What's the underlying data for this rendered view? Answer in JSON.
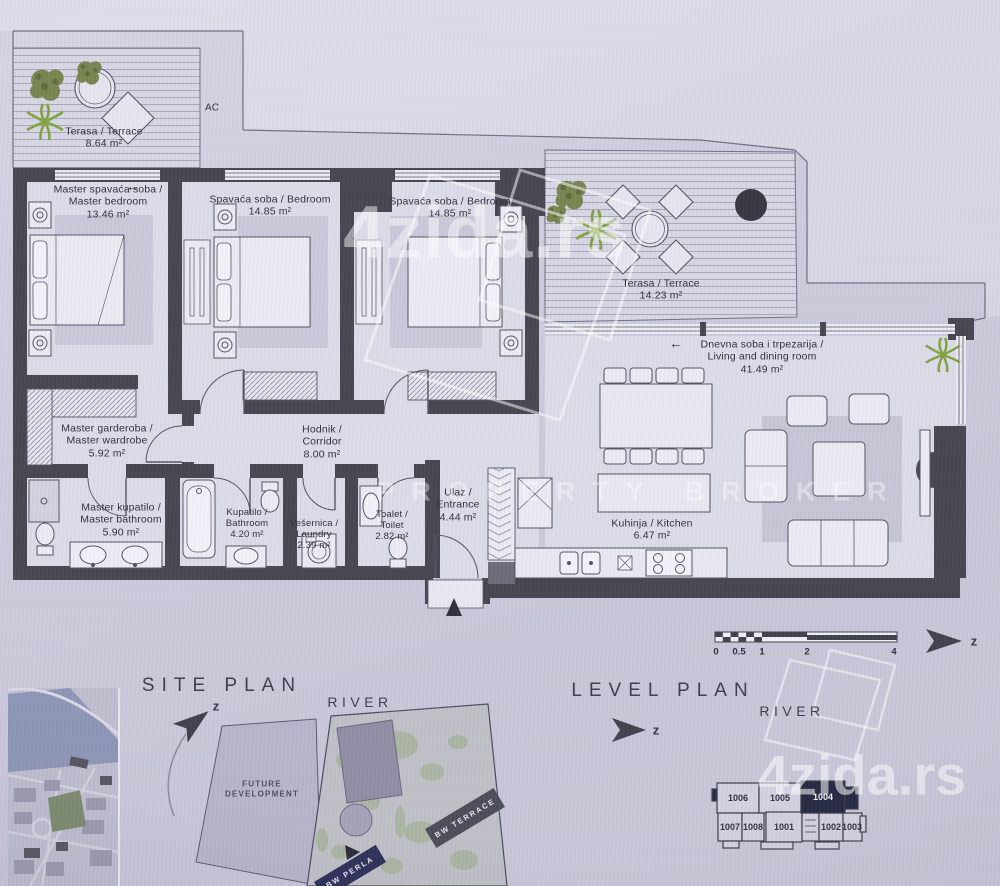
{
  "watermark": {
    "brand_top": "4zida.rs",
    "brand_bottom": "4zida.rs",
    "broker": "PROPERTY BROKER"
  },
  "plan": {
    "ac_label": "AC",
    "arrow": "←",
    "rooms": [
      {
        "line1": "Terasa / Terrace",
        "area": "8.64 m²"
      },
      {
        "line1": "Master spavaća soba /",
        "line2": "Master bedroom",
        "area": "13.46 m²"
      },
      {
        "line1": "Spavaća soba / Bedroom",
        "area": "14.85 m²"
      },
      {
        "line1": "Spavaća soba / Bedroom",
        "area": "14.85 m²"
      },
      {
        "line1": "Terasa / Terrace",
        "area": "14.23 m²"
      },
      {
        "line1": "Dnevna soba i trpezarija /",
        "line2": "Living and dining room",
        "area": "41.49 m²"
      },
      {
        "line1": "Master garderoba /",
        "line2": "Master wardrobe",
        "area": "5.92 m²"
      },
      {
        "line1": "Hodnik /",
        "line2": "Corridor",
        "area": "8.00 m²"
      },
      {
        "line1": "Master kupatilo /",
        "line2": "Master bathroom",
        "area": "5.90 m²"
      },
      {
        "line1": "Kupatilo /",
        "line2": "Bathroom",
        "area": "4.20 m²"
      },
      {
        "line1": "Vešernica /",
        "line2": "Laundry",
        "area": "2.39 m²"
      },
      {
        "line1": "Toalet /",
        "line2": "Toilet",
        "area": "2.82 m²"
      },
      {
        "line1": "Ulaz /",
        "line2": "Entrance",
        "area": "4.44 m²"
      },
      {
        "line1": "Kuhinja / Kitchen",
        "area": "6.47 m²"
      }
    ]
  },
  "footer": {
    "site_plan": {
      "title": "SITE PLAN",
      "river_label": "RIVER",
      "north": "z",
      "future_line1": "FUTURE",
      "future_line2": "DEVELOPMENT",
      "building_terrace": "BW TERRACE",
      "building_perla": "BW PERLA"
    },
    "level_plan": {
      "title": "LEVEL PLAN",
      "river_label": "RIVER",
      "north": "z",
      "units_top": [
        "1006",
        "1005",
        "1004"
      ],
      "units_bottom": [
        "1007",
        "1008",
        "1001",
        "1002",
        "1003"
      ],
      "highlighted_unit": "1004"
    },
    "scale_bar": {
      "ticks": [
        "0",
        "0.5",
        "1",
        "2",
        "4"
      ],
      "north": "z"
    }
  },
  "colors": {
    "wall": "#45444e",
    "floor": "#dcdbe8",
    "highlight_unit": "#23263f",
    "perla_navy": "#2b2e57",
    "plant_green": "#7fa23e"
  }
}
